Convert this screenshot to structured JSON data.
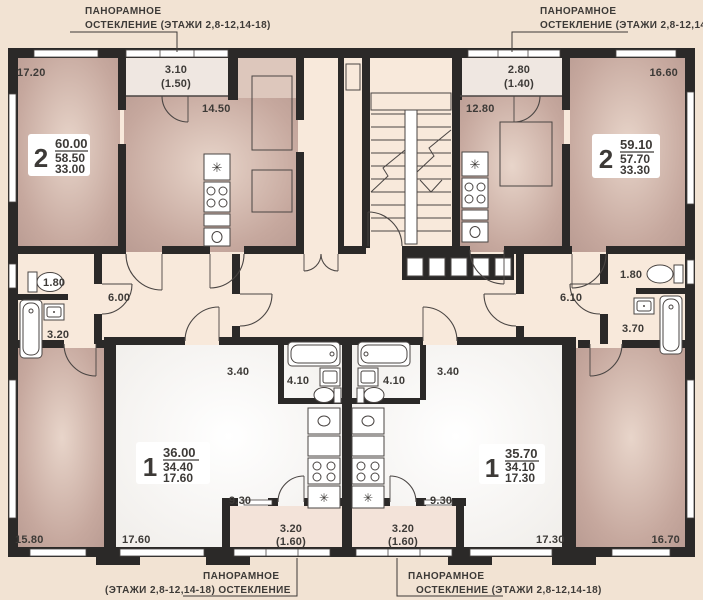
{
  "plan_title": "Типовой этаж — план квартир",
  "colors": {
    "wall": "#2b2928",
    "background": "#f2e3d3",
    "room_warm": "#c6a89e",
    "room_warm_light": "#ddc7bc",
    "room_white": "#fbfaf8",
    "corridor": "#f8e9db",
    "loggia": "#efe7e1",
    "balcony": "#f3e3d9",
    "text": "#3d3a37"
  },
  "icons": {
    "fridge_glyph": "✳"
  },
  "annotations": {
    "top_left": {
      "line1": "ПАНОРАМНОЕ",
      "line2": "ОСТЕКЛЕНИЕ (ЭТАЖИ 2,8-12,14-18)"
    },
    "top_right": {
      "line1": "ПАНОРАМНОЕ",
      "line2": "ОСТЕКЛЕНИЕ (ЭТАЖИ 2,8-12,14-18)"
    },
    "bottom_left": {
      "line1": "ПАНОРАМНОЕ",
      "line2": "(ЭТАЖИ 2,8-12,14-18) ОСТЕКЛЕНИЕ"
    },
    "bottom_right": {
      "line1": "ПАНОРАМНОЕ",
      "line2": "ОСТЕКЛЕНИЕ (ЭТАЖИ 2,8-12,14-18)"
    }
  },
  "apartments": {
    "top_left": {
      "number": "2",
      "area_total": "60.00",
      "area_living": "58.50",
      "area_rooms": "33.00"
    },
    "top_right": {
      "number": "2",
      "area_total": "59.10",
      "area_living": "57.70",
      "area_rooms": "33.30"
    },
    "bottom_left": {
      "number": "1",
      "area_total": "36.00",
      "area_living": "34.40",
      "area_rooms": "17.60"
    },
    "bottom_right": {
      "number": "1",
      "area_total": "35.70",
      "area_living": "34.10",
      "area_rooms": "17.30"
    }
  },
  "dims": {
    "tl_room": "17.20",
    "tl_loggia": "3.10",
    "tl_loggia_sub": "(1.50)",
    "tl_kitchen": "14.50",
    "tr_kitchen": "12.80",
    "tr_loggia": "2.80",
    "tr_loggia_sub": "(1.40)",
    "tr_room": "16.60",
    "l_wc": "1.80",
    "l_hall": "6.00",
    "l_bath": "3.20",
    "r_hall": "6.10",
    "r_wc": "1.80",
    "r_bath": "3.70",
    "bl_hall": "3.40",
    "bl_bath": "4.10",
    "br_bath": "4.10",
    "br_hall": "3.40",
    "bl_room_corner": "15.80",
    "bl_living": "17.60",
    "bl_kitchen": "9.30",
    "br_kitchen": "9.30",
    "br_living": "17.30",
    "br_room_corner": "16.70",
    "bl_balcony": "3.20",
    "bl_balcony_sub": "(1.60)",
    "br_balcony": "3.20",
    "br_balcony_sub": "(1.60)"
  }
}
